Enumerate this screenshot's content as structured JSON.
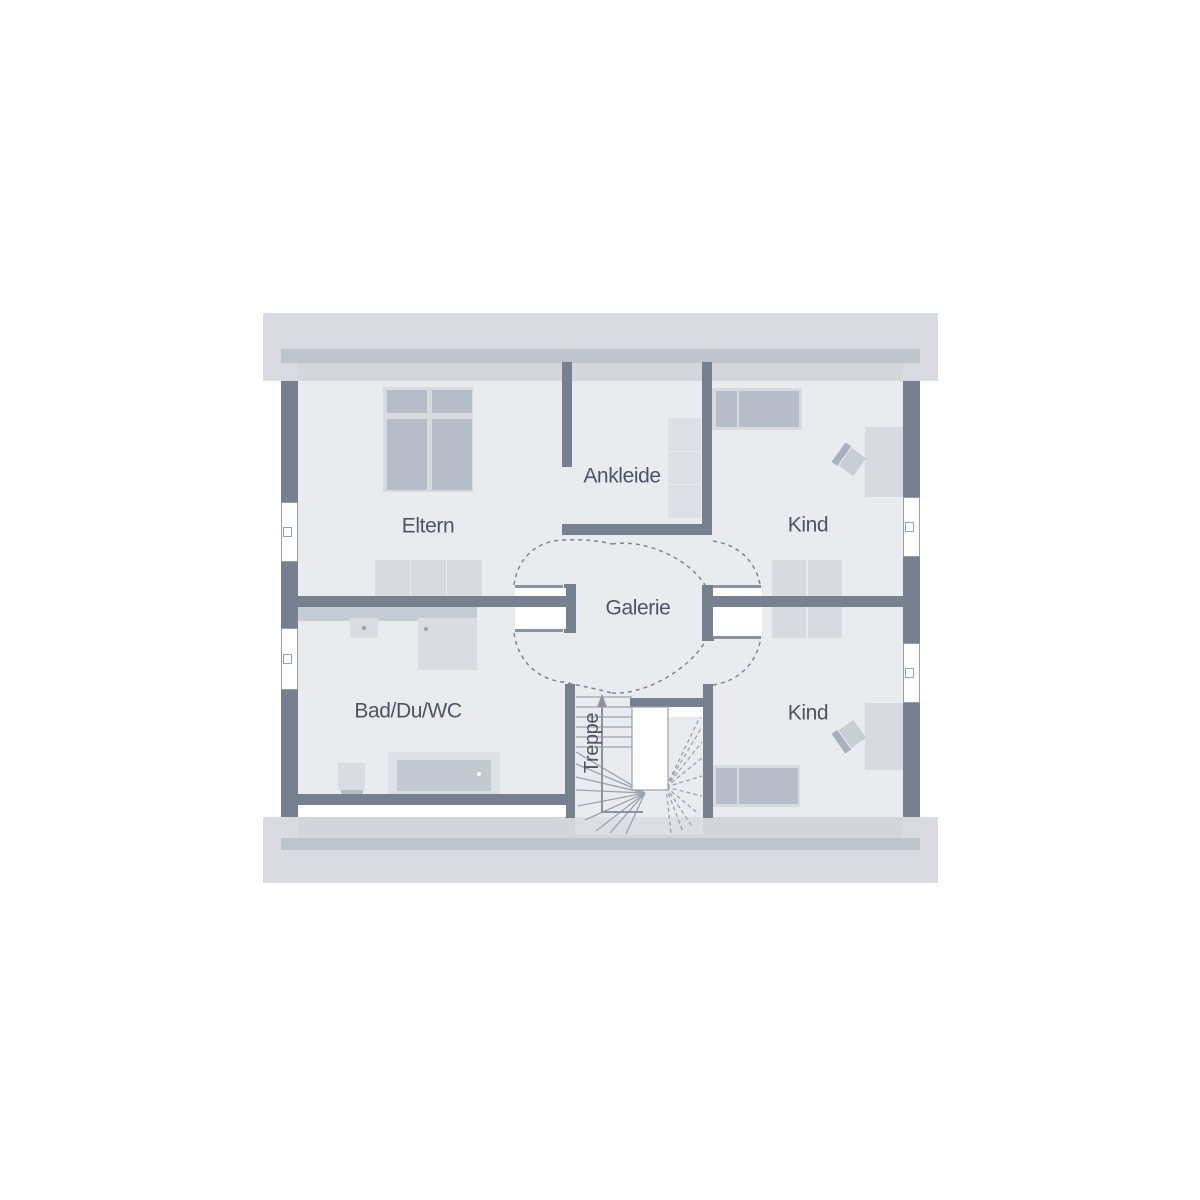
{
  "rooms": {
    "eltern": {
      "label": "Eltern"
    },
    "ankleide": {
      "label": "Ankleide"
    },
    "kind_top": {
      "label": "Kind"
    },
    "galerie": {
      "label": "Galerie"
    },
    "bad": {
      "label": "Bad/Du/WC"
    },
    "kind_bottom": {
      "label": "Kind"
    },
    "treppe": {
      "label": "Treppe"
    }
  },
  "colors": {
    "roof_band": "#d9dbe0",
    "shaded_exterior_wall": "#bec4cc",
    "knee_strip": "#d3d6db",
    "floor": "#e9ebef",
    "wall": "#76808e",
    "furniture_light": "#d7dbe0",
    "furniture_dark": "#b6bcc8",
    "fixture": "#d9dce1",
    "stair_line": "#9aa2ad",
    "door_leaf": "#8a93a2",
    "swing_arc": "#7b8595",
    "label_text": "#4b5565"
  }
}
